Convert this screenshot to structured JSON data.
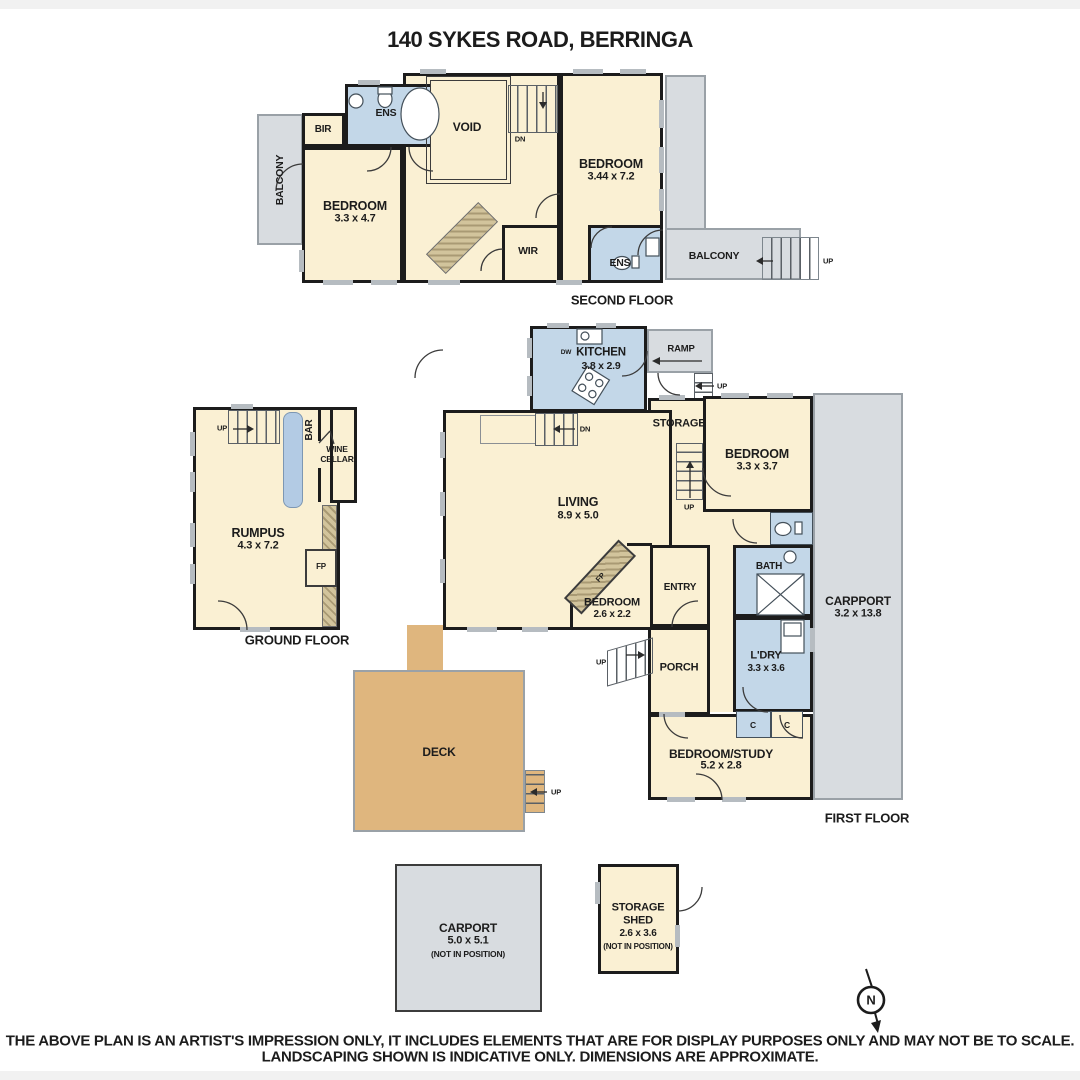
{
  "title": "140 SYKES ROAD, BERRINGA",
  "colors": {
    "room_cream": "#faf0d3",
    "wet_blue": "#c3d7e8",
    "outdoor_gray": "#d8dce0",
    "deck_tan": "#dfb67e",
    "wall": "#1c1c1c"
  },
  "labels": {
    "up": "UP",
    "dn": "DN",
    "fp": "FP",
    "c": "C",
    "dw": "DW"
  },
  "second_floor": {
    "floor_label": "SECOND FLOOR",
    "balcony_left": "BALCONY",
    "balcony_right": "BALCONY",
    "bir": "BIR",
    "ens_top": "ENS",
    "ens_bottom": "ENS",
    "void": "VOID",
    "wir": "WIR",
    "bedroom_right": {
      "name": "BEDROOM",
      "dims": "3.44 x 7.2"
    },
    "bedroom_left": {
      "name": "BEDROOM",
      "dims": "3.3 x 4.7"
    }
  },
  "ground_floor": {
    "floor_label": "GROUND FLOOR",
    "rumpus": {
      "name": "RUMPUS",
      "dims": "4.3 x 7.2"
    },
    "bar": "BAR",
    "wine_cellar": {
      "line1": "WINE",
      "line2": "CELLAR"
    }
  },
  "first_floor": {
    "floor_label": "FIRST FLOOR",
    "kitchen": {
      "name": "KITCHEN",
      "dims": "3.8 x 2.9"
    },
    "ramp": "RAMP",
    "storage": "STORAGE",
    "living": {
      "name": "LIVING",
      "dims": "8.9 x 5.0"
    },
    "bedroom_top": {
      "name": "BEDROOM",
      "dims": "3.3 x 3.7"
    },
    "bedroom_small": {
      "name": "BEDROOM",
      "dims": "2.6 x 2.2"
    },
    "bedroom_study": {
      "name": "BEDROOM/STUDY",
      "dims": "5.2 x 2.8"
    },
    "entry": "ENTRY",
    "bath": "BATH",
    "carport": {
      "name": "CARPPORT",
      "dims": "3.2 x 13.8"
    },
    "laundry": {
      "name": "L'DRY",
      "dims": "3.3 x 3.6"
    },
    "porch": "PORCH",
    "deck": "DECK"
  },
  "outbuildings": {
    "carport": {
      "name": "CARPORT",
      "dims": "5.0 x 5.1",
      "note": "(NOT IN POSITION)"
    },
    "storage_shed": {
      "line1": "STORAGE",
      "line2": "SHED",
      "dims": "2.6 x 3.6",
      "note": "(NOT IN POSITION)"
    }
  },
  "compass_label": "N",
  "disclaimer_line1": "THE ABOVE PLAN IS AN ARTIST'S IMPRESSION ONLY, IT INCLUDES ELEMENTS THAT ARE FOR DISPLAY PURPOSES ONLY AND MAY NOT BE TO SCALE.",
  "disclaimer_line2": "LANDSCAPING SHOWN IS INDICATIVE ONLY. DIMENSIONS ARE APPROXIMATE."
}
